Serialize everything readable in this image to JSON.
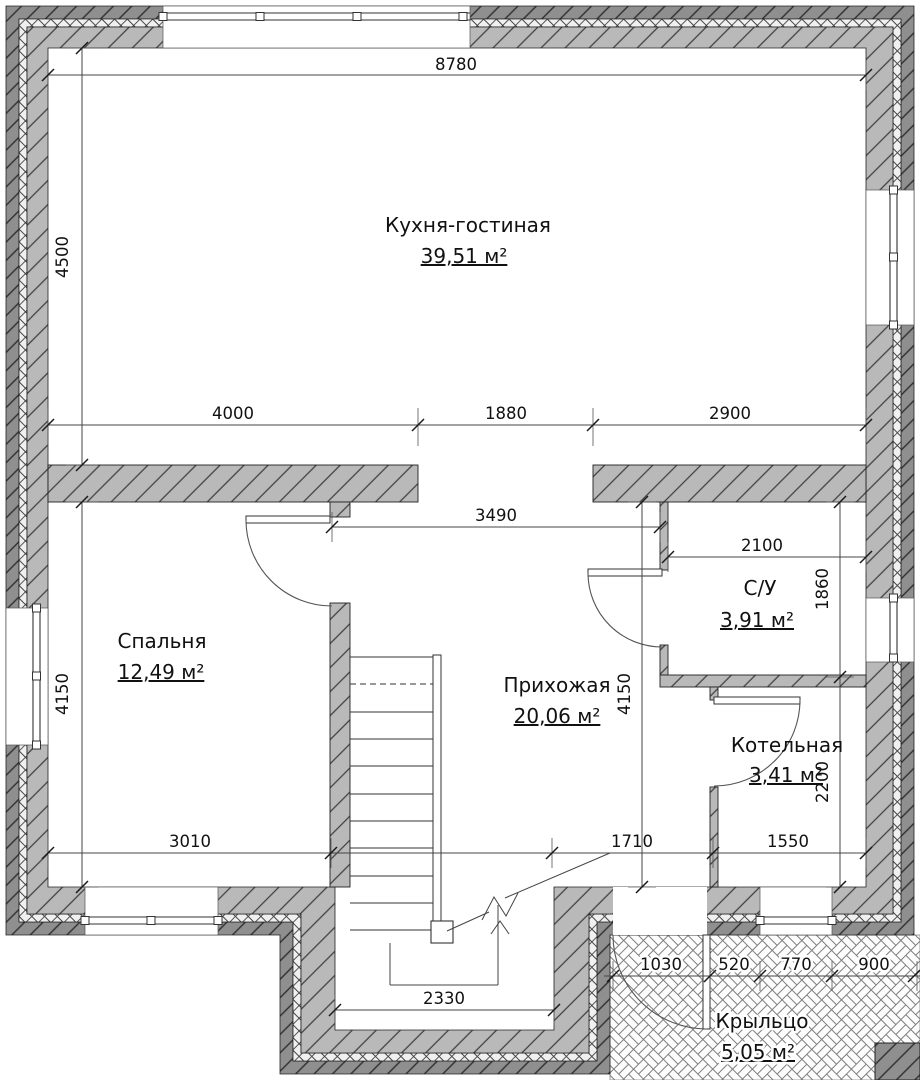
{
  "rooms": [
    {
      "name": "Кухня-гостиная",
      "area": "39,51 м²"
    },
    {
      "name": "Спальня",
      "area": "12,49 м²"
    },
    {
      "name": "Прихожая",
      "area": "20,06 м²"
    },
    {
      "name": "С/У",
      "area": "3,91 м²"
    },
    {
      "name": "Котельная",
      "area": "3,41 м²"
    },
    {
      "name": "Крыльцо",
      "area": "5,05 м²"
    }
  ],
  "dims": {
    "overall_width": "8780",
    "kitchen_depth": "4500",
    "kitchen_seg1": "4000",
    "kitchen_opening": "1880",
    "kitchen_seg2": "2900",
    "hall_top_width": "3490",
    "su_width": "2100",
    "su_depth": "1860",
    "bedroom_depth": "4150",
    "hall_depth": "4150",
    "boiler_depth": "2200",
    "bedroom_width": "3010",
    "entry_span": "1710",
    "boiler_width": "1550",
    "porch_seg1": "1030",
    "porch_seg2": "520",
    "porch_seg3": "770",
    "porch_seg4": "900",
    "stair_well_width": "2330"
  },
  "colors": {
    "wall_outer": "#8f8f8f",
    "wall_inner": "#b9b9b9",
    "insulation_bg": "#f0f0f0",
    "line": "#1a1a1a",
    "paper": "#ffffff"
  }
}
